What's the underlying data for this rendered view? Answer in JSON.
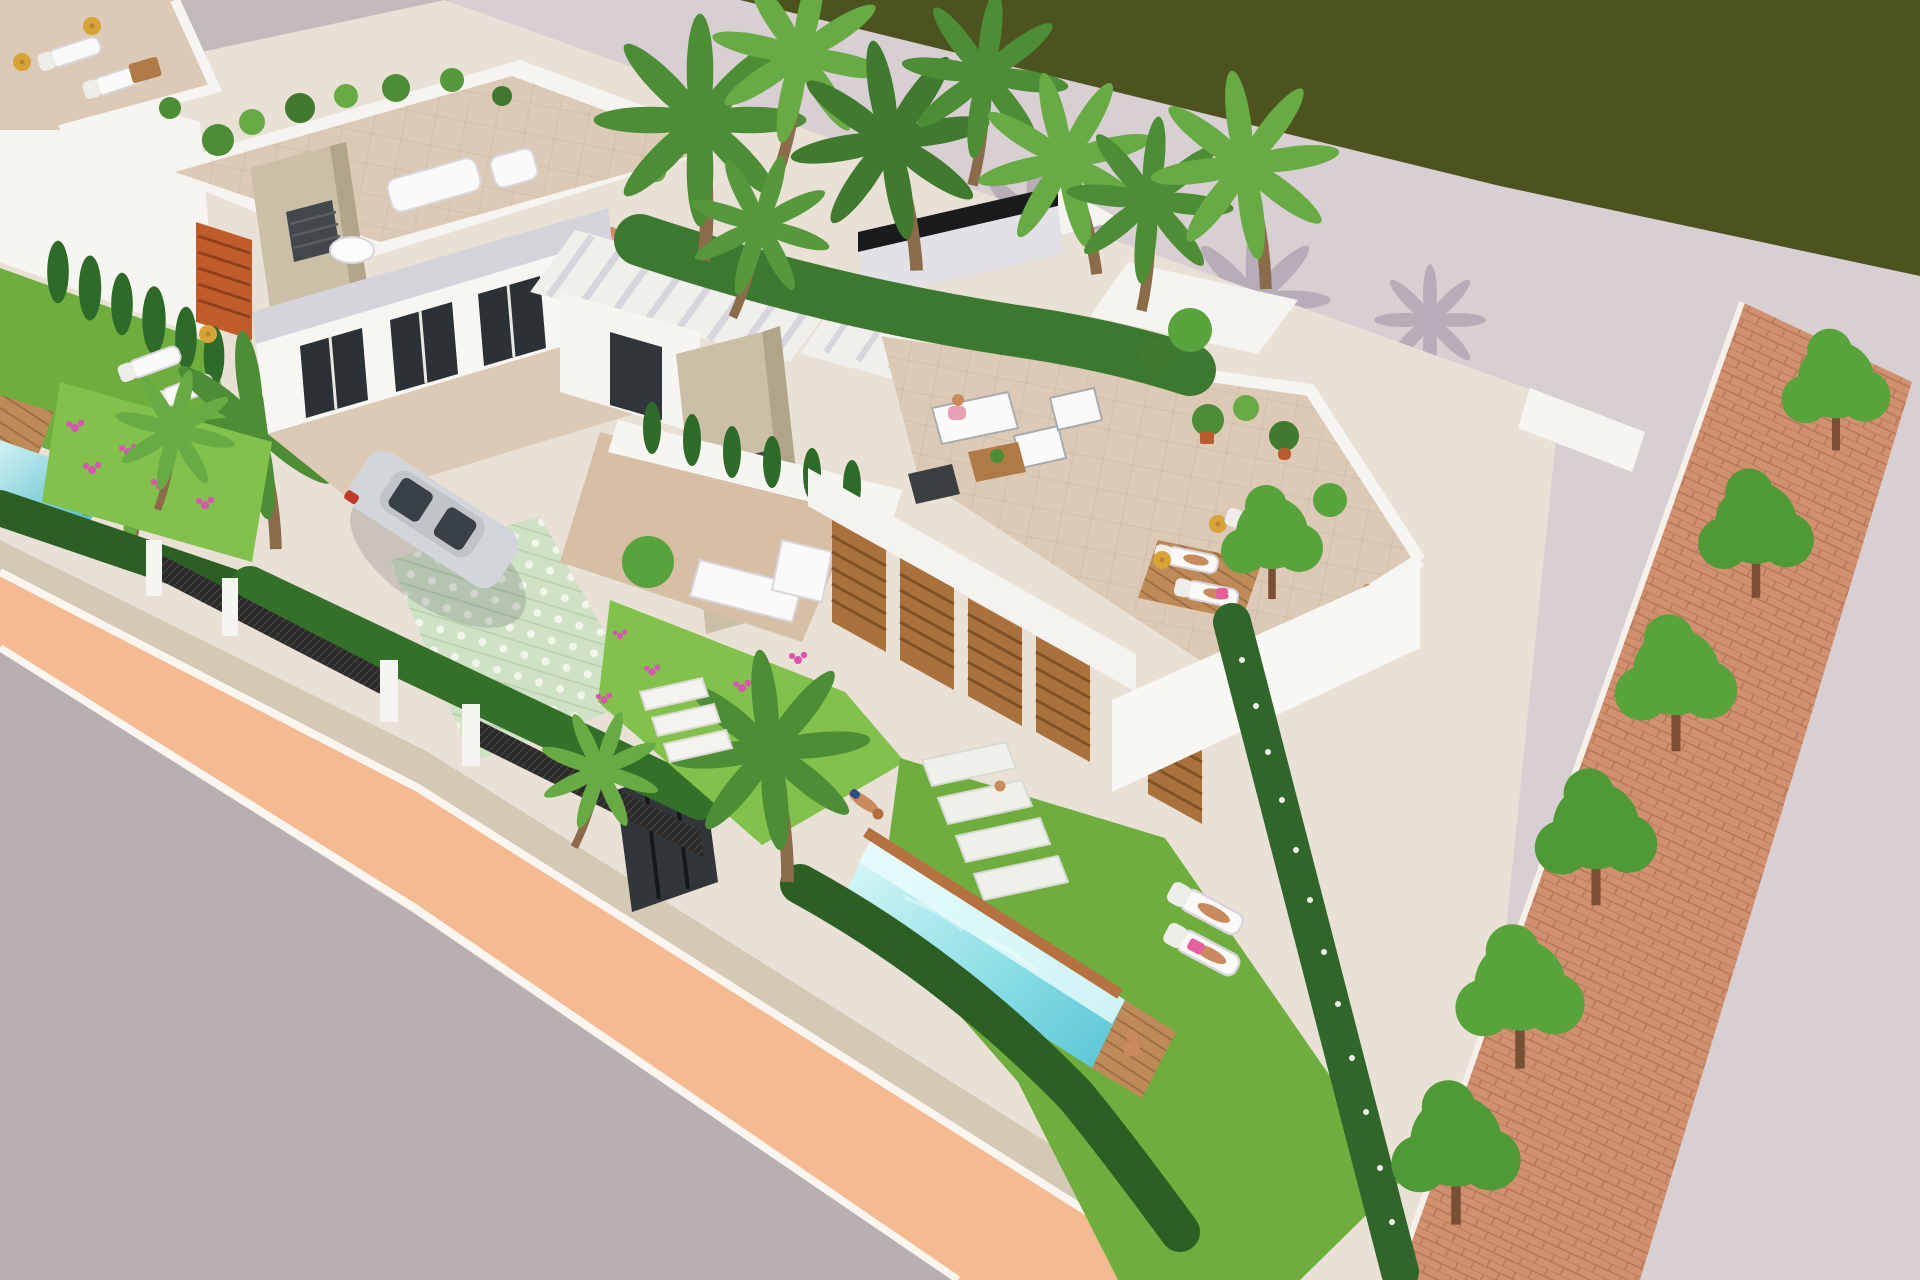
{
  "scene": {
    "type": "3d-architectural-render",
    "description": "Aerial 3D rendering of a modern villa development: white flat-roof villas with roof terraces, wooden louver facades, private turquoise pools and bright green gardens, set between a dark lagoon with a light stone promenade (top) and an asphalt street with a salmon footpath (bottom), tree-lined brick walk on the right.",
    "features": [
      "lagoon water",
      "stone promenade",
      "palm trees",
      "roof terraces with lounge furniture",
      "private pool with diver",
      "sun loungers",
      "parked car",
      "mesh fence",
      "salmon footpath",
      "asphalt road",
      "tree row on brick path"
    ]
  },
  "colors": {
    "water": "#4d531f",
    "promenade": "#d8cfd3",
    "street_far": "#c2babd",
    "road": "#b8afb3",
    "footpath": "#f4ba92",
    "curb": "#faf6ef",
    "gravel": "#d3c9b5",
    "property_ground": "#e9e1d5",
    "lawn": "#6fae3e",
    "lawn_bright": "#82c14b",
    "hedge": "#3c7830",
    "hedge_dark": "#2c5f23",
    "cypress": "#2f6b28",
    "palm": "#4d8d36",
    "palm_light": "#68ab45",
    "tree": "#58a33c",
    "flower_pink": "#d855b0",
    "flower_white": "#f3f6ec",
    "villa_white": "#f7f5f2",
    "villa_shade": "#d6d4db",
    "villa_dark": "#c3c1ca",
    "glass": "#2b3135",
    "stone": "#cbbfa7",
    "stone_shade": "#b0a489",
    "vent": "#41474a",
    "wood": "#a9713c",
    "wood_dark": "#7f5226",
    "deck": "#bd8a58",
    "terrace_tile": "#dccab6",
    "driveway_tile": "#cfe2c6",
    "brick": "#d1906e",
    "fence": "#2c2b29",
    "car_silver": "#d2d5d9",
    "car_glass": "#394147",
    "car_tail": "#c0392b",
    "skin": "#c98a5e",
    "pool_shallow": "#d6f6f6",
    "pool_deep": "#5fc8d8",
    "pool_wall": "#eafcfc",
    "pot_terracotta": "#b85c2e",
    "parasol_gold": "#d8a437",
    "towel_pink": "#e4619e",
    "mat_dark": "#2f3335"
  }
}
